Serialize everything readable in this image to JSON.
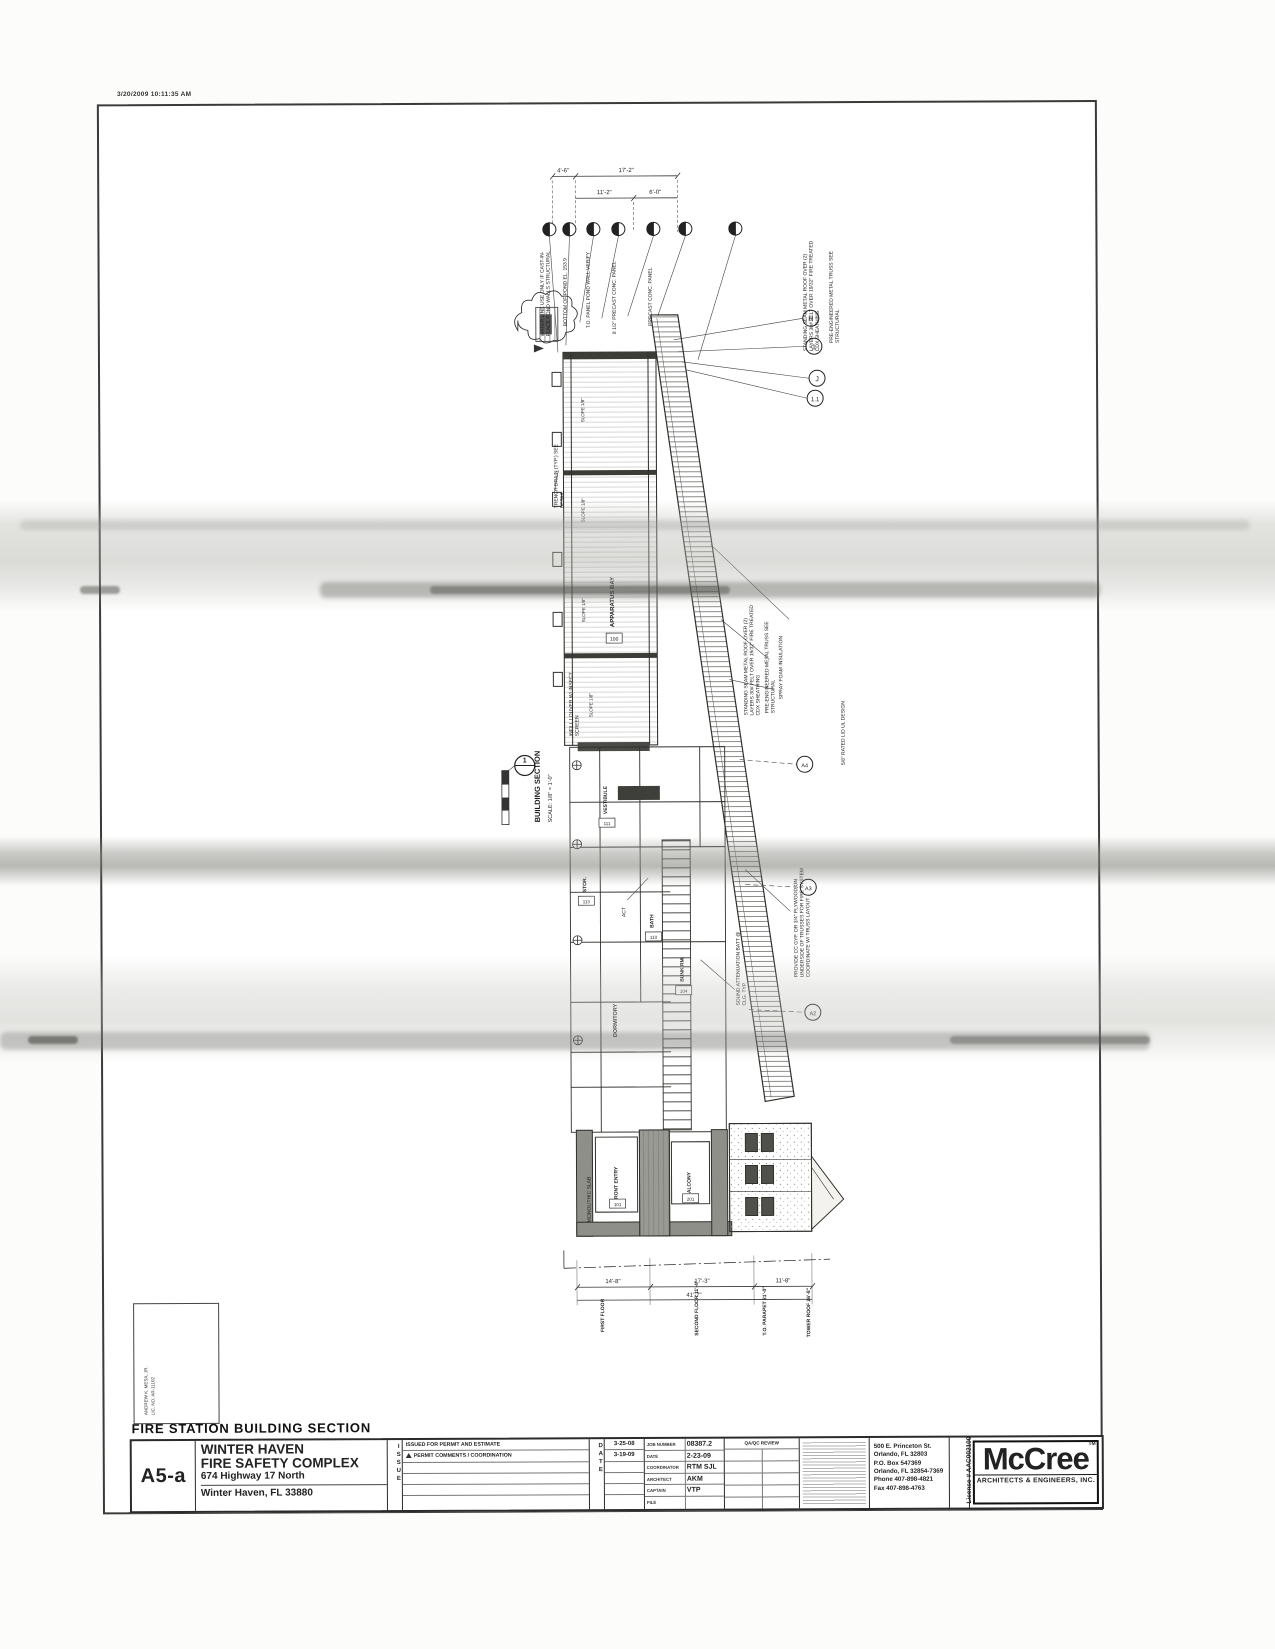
{
  "scan": {
    "timestamp": "3/20/2009 10:11:35 AM"
  },
  "drawing": {
    "caption": "FIRE STATION BUILDING SECTION",
    "section_number": "1",
    "view_title": "BUILDING SECTION",
    "view_scale": "SCALE: 1/8\" = 1'-0\"",
    "dims_top": [
      "4'-6\"",
      "17'-2\"",
      "11'-2\"",
      "6'-0\""
    ],
    "dims_bottom": [
      "14'-8\"",
      "17'-3\"",
      "11'-8\"",
      "41'-7\""
    ],
    "levels": [
      "FIRST FLOOR",
      "SECOND FLOOR 11'-4\"",
      "T.O. PARAPET 21'-0\"",
      "TOWER ROOF 26'-8\""
    ],
    "grid_top": [
      "H",
      "1",
      "J",
      "1.1"
    ],
    "grid_side": [
      "A4",
      "A3",
      "A2"
    ],
    "rooms": [
      {
        "name": "APPARATUS BAY",
        "tag": "100"
      },
      {
        "name": "VESTIBULE",
        "tag": "111"
      },
      {
        "name": "STOR.",
        "tag": "113"
      },
      {
        "name": "BATH",
        "tag": "110"
      },
      {
        "name": "BUNK RM.",
        "tag": "104"
      },
      {
        "name": "DORMITORY",
        "tag": "105"
      },
      {
        "name": "FRONT ENTRY",
        "tag": "101"
      },
      {
        "name": "BALCONY",
        "tag": "201"
      }
    ],
    "notes": [
      "WATER LINE USE ONLY IF CAST-IN-PLACE POND WALLS STRUCTURAL",
      "BOTTOM OF POND EL. 153.9",
      "T.O. PANEL POND WALL VERIFY",
      "8 1/2\" PRECAST CONC. PANEL",
      "PRECAST CONC. PANEL",
      "STANDING SEAM METAL ROOF OVER (2) LAYERS 30# FELT OVER 19/32\" FIRE TREATED CDX SHEATHING",
      "PRE-ENGINEERED METAL TRUSS SEE STRUCTURAL",
      "TRENCH DRAIN (TYP.) SEE DETAIL",
      "SLOPE 1/8\"",
      "INFILL LOUVER W/ INSECT SCREEN",
      "SPRAY FOAM INSULATION",
      "5/8\" RATED LID UL DESIGN",
      "PROVIDE CC GYP. OR 3/4\" PLYWOOD ON UNDERSIDE OF TRUSSES FOR FIRE SYSTEM COORDINATE W/ TRUSS LAYOUT",
      "SOUND ATTENUATION BATT @ CLG. TYP.",
      "MONOLITHIC SLAB",
      "ACT"
    ]
  },
  "seal": {
    "architect": "ANDREW K. MESA, JR.",
    "license": "LIC. NO. AR-11102"
  },
  "titleblock": {
    "sheet_number": "A5-a",
    "project_line1": "WINTER HAVEN",
    "project_line2": "FIRE SAFETY COMPLEX",
    "project_line3": "674 Highway 17 North",
    "project_line4": "Winter Haven, FL 33880",
    "issue_vertical": "ISSUE",
    "date_vertical": "DATE",
    "issues": [
      {
        "desc": "ISSUED FOR PERMIT AND ESTIMATE",
        "date": "3-25-08"
      },
      {
        "desc": "PERMIT COMMENTS / COORDINATION",
        "date": "3-19-09"
      }
    ],
    "fields": [
      {
        "label": "JOB NUMBER",
        "value": "08387.2"
      },
      {
        "label": "DATE",
        "value": "2-23-09"
      },
      {
        "label": "COORDINATOR",
        "value": "RTM SJL"
      },
      {
        "label": "ARCHITECT",
        "value": "AKM"
      },
      {
        "label": "CAPTAIN",
        "value": "VTP"
      },
      {
        "label": "FILE",
        "value": ""
      }
    ],
    "qaqc_label": "QA/QC REVIEW",
    "firm": {
      "name": "McCree",
      "tm": "TM",
      "tagline": "ARCHITECTS & ENGINEERS, INC.",
      "license": "License # AAC002100",
      "addr1": "500 E. Princeton St.",
      "addr2": "Orlando, FL 32803",
      "addr3": "P.O. Box 547369",
      "addr4": "Orlando, FL 32854-7369",
      "addr5": "Phone 407-898-4821",
      "addr6": "Fax 407-898-4763"
    }
  }
}
